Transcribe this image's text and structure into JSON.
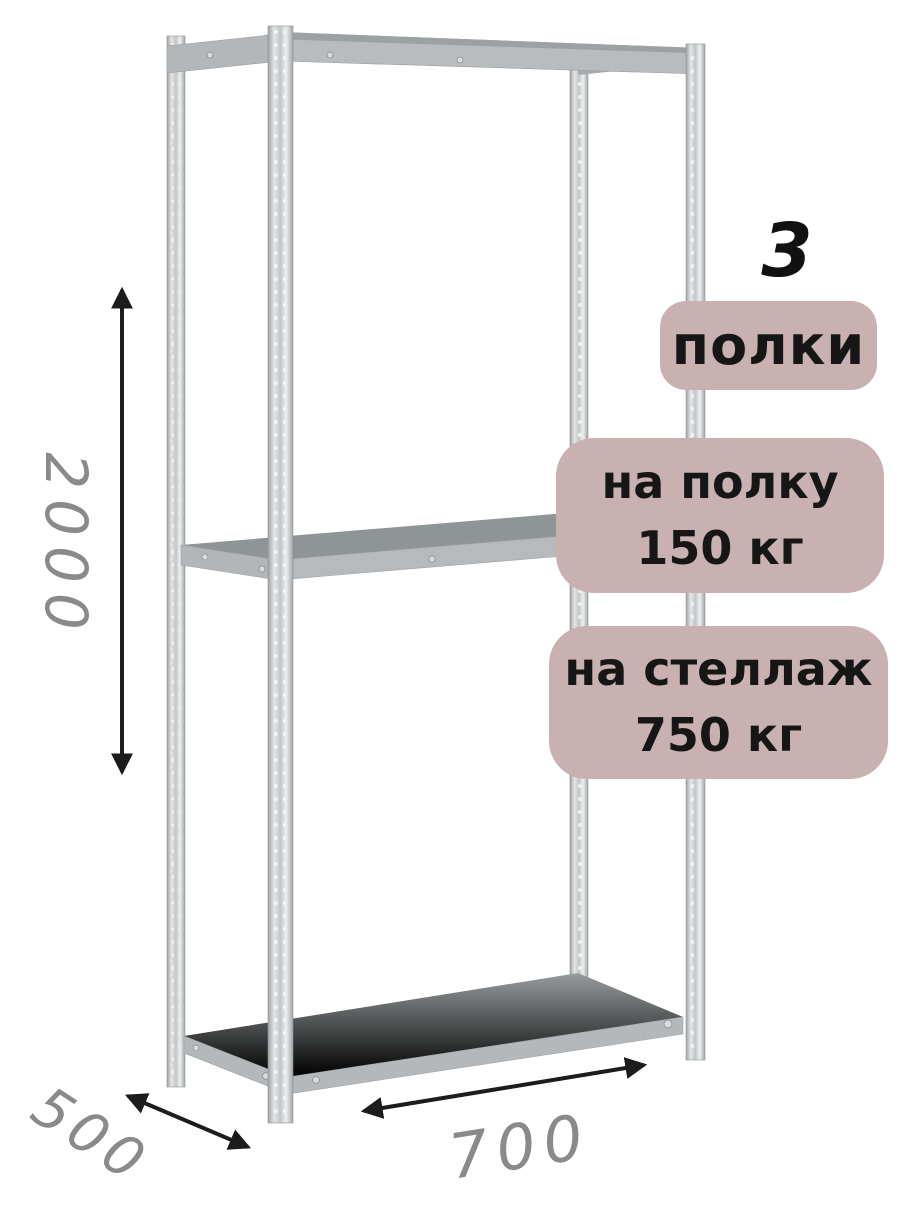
{
  "badges": {
    "count": "3",
    "count_label": "полки",
    "shelf_load_line1": "на полку",
    "shelf_load_line2": "150 кг",
    "rack_load_line1": "на стеллаж",
    "rack_load_line2": "750 кг"
  },
  "dimensions": {
    "height": "2000",
    "depth": "500",
    "width": "700"
  },
  "colors": {
    "badge_background": "#cab1b1",
    "badge_text": "#161616",
    "count_text": "#111111",
    "dimension_text": "#8a8a8a",
    "arrow": "#1c1c1c",
    "post_metal_light": "#e3e5e6",
    "post_metal_dark": "#9fa3a5",
    "shelf_surface": "#8b9092",
    "shelf_edge": "#b6babc",
    "background": "#ffffff"
  },
  "icons": {
    "height_arrow": "double-headed-vertical-arrow",
    "depth_arrow": "double-headed-diagonal-arrow",
    "width_arrow": "double-headed-diagonal-arrow"
  }
}
